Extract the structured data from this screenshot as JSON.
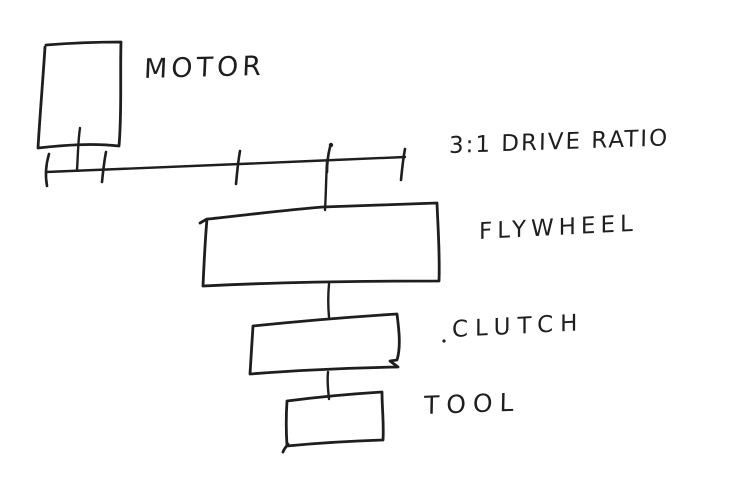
{
  "canvas": {
    "width": 750,
    "height": 478,
    "colors": {
      "paper": "#ffffff",
      "ink": "#1e1e1e"
    }
  },
  "diagram": {
    "type": "hand-drawn mechanical power-train schematic",
    "labels": {
      "motor": "MOTOR",
      "drive_ratio": "3:1 DRIVE RATIO",
      "flywheel": "FLYWHEEL",
      "clutch": "CLUTCH",
      "tool": "TOOL"
    },
    "edges": [
      {
        "from": "motor",
        "to": "drive-shaft"
      },
      {
        "from": "drive-shaft",
        "to": "flywheel"
      },
      {
        "from": "flywheel",
        "to": "clutch"
      },
      {
        "from": "clutch",
        "to": "tool"
      }
    ]
  }
}
